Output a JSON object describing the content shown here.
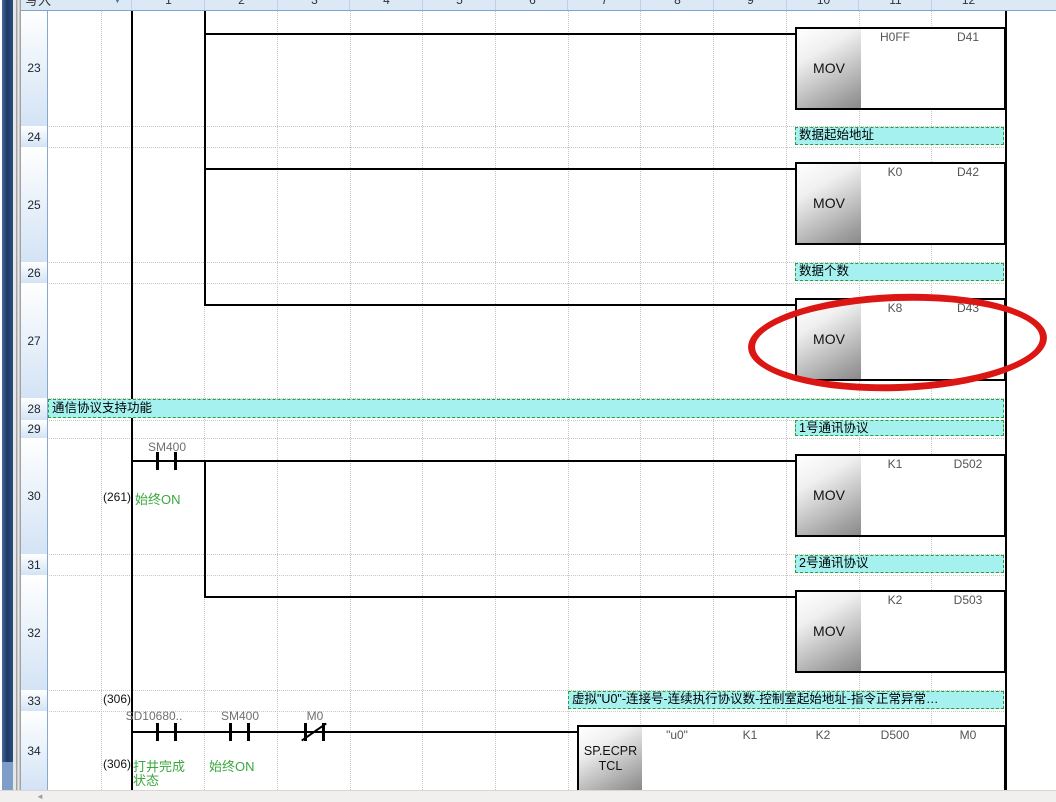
{
  "toolbar": {
    "mode_label": "写入"
  },
  "icons": {
    "mode_dropdown": "▼",
    "scroll_left": "◄"
  },
  "grid": {
    "columns": [
      "1",
      "2",
      "3",
      "4",
      "5",
      "6",
      "7",
      "8",
      "9",
      "10",
      "11",
      "12"
    ]
  },
  "row_numbers": [
    "23",
    "24",
    "25",
    "26",
    "27",
    "28",
    "29",
    "30",
    "31",
    "32",
    "33",
    "34"
  ],
  "comments": {
    "c24": "数据起始地址",
    "c26": "数据个数",
    "c28": "通信协议支持功能",
    "c29": "1号通讯协议",
    "c31": "2号通讯协议",
    "c33": "虚拟\"U0\"-连接号-连续执行协议数-控制室起始地址-指令正常异常…"
  },
  "instructions": {
    "mov23": {
      "name": "MOV",
      "p1": "H0FF",
      "p2": "D41"
    },
    "mov25": {
      "name": "MOV",
      "p1": "K0",
      "p2": "D42"
    },
    "mov27": {
      "name": "MOV",
      "p1": "K8",
      "p2": "D43"
    },
    "mov30": {
      "name": "MOV",
      "p1": "K1",
      "p2": "D502"
    },
    "mov32": {
      "name": "MOV",
      "p1": "K2",
      "p2": "D503"
    },
    "ecprtcl": {
      "l1": "SP.ECPR",
      "l2": "TCL",
      "p1": "\"u0\"",
      "p2": "K1",
      "p3": "K2",
      "p4": "D500",
      "p5": "M0"
    }
  },
  "contacts": {
    "r30_sm400": "SM400",
    "r34_sd10680": "SD10680..",
    "r34_sm400": "SM400",
    "r34_m0": "M0"
  },
  "steps": {
    "r30": "(261)",
    "r33": "(306)",
    "r34": "(306)"
  },
  "notes": {
    "r30": "始终ON",
    "r34_line1": "打井完成",
    "r34_line2": "状态",
    "r34_sm": "始终ON"
  },
  "colors": {
    "comment_bg": "#a4f1ef",
    "comment_border": "#2d9e35",
    "note_green": "#3aa83e",
    "annotation_red": "#dc1612",
    "header_bg": "#dbe8f6",
    "dock_navy": "#1d3b66"
  }
}
